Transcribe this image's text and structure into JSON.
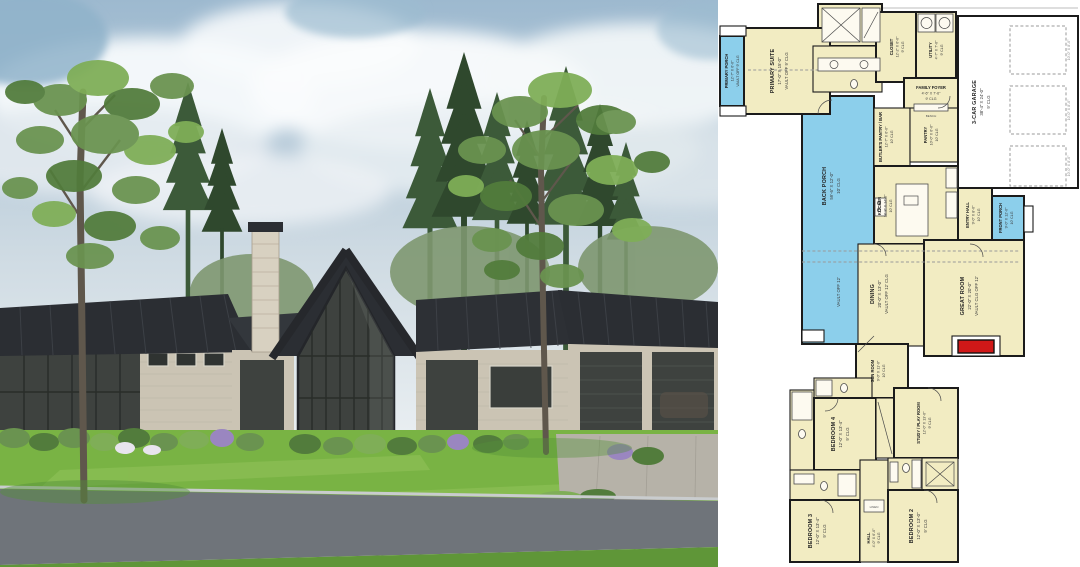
{
  "page": {
    "description": "Split image: modern ranch house exterior render (left) and floor plan (right)"
  },
  "palette": {
    "sky_top": "#9db9cf",
    "sky_bottom": "#e9eef1",
    "cloud": "#f7fafc",
    "grass": "#79b344",
    "grass_dark": "#5f9638",
    "road": "#6f747a",
    "curb": "#c9ccce",
    "roof": "#2b2e33",
    "stone": "#cbc4b4",
    "stone_light": "#d8d1c1",
    "glass": "#3e423f",
    "pine": "#3c5a39",
    "pine_dark": "#2f482d",
    "leaf": "#6a9350",
    "trunk": "#645a4e",
    "driveway": "#b6b2a8",
    "plan_room": "#f2ecc2",
    "plan_porch": "#8ccfeb",
    "plan_wall": "#1b1b1b",
    "fireplace": "#d01818"
  },
  "floor_plan": {
    "garage_door_label": "10'-0\" X 8'-0\"",
    "notes": {
      "vault_note": "VAULT OFF 12'",
      "bench": "BENCH",
      "linen": "LINEN"
    },
    "rooms": [
      {
        "name": "PRIMARY PORCH",
        "dims": "12'-7\" X 6'-0\"",
        "ceiling": "VAULT OFF 9' CLG"
      },
      {
        "name": "PRIMARY SUITE",
        "dims": "17'-0\" X 15'-0\"",
        "ceiling": "VAULT OFF 9' CLG"
      },
      {
        "name": "CLOSET",
        "dims": "12'-2\" X 6'-0\"",
        "ceiling": "9' CLG"
      },
      {
        "name": "UTILITY",
        "dims": "4'-7\" X 7'-0\"",
        "ceiling": "9' CLG"
      },
      {
        "name": "FAMILY FOYER",
        "dims": "4'-6\" X 7'-6\"",
        "ceiling": "9' CLG"
      },
      {
        "name": "3-CAR GARAGE",
        "dims": "38'-4\" X 24'-0\"",
        "ceiling": "9' CLG"
      },
      {
        "name": "BUTLER'S PANTRY / BAR",
        "dims": "12'-7\" X 6'-0\"",
        "ceiling": "10' CLG"
      },
      {
        "name": "PANTRY",
        "dims": "10'-0\" X 6'-0\"",
        "ceiling": "10' CLG"
      },
      {
        "name": "KITCHEN",
        "dims": "18'-8\" X 14'-6\"",
        "ceiling": "10' CLG"
      },
      {
        "name": "ENTRY HALL",
        "dims": "9'-0\" X 8'-0\"",
        "ceiling": "10' CLG"
      },
      {
        "name": "FRONT PORCH",
        "dims": "9'-0\" X 12'-0\"",
        "ceiling": "10' CLG"
      },
      {
        "name": "BACK PORCH",
        "dims": "59'-6\" X 12'-0\"",
        "ceiling": "10' CLG"
      },
      {
        "name": "DINING",
        "dims": "20'-0\" X 13'-0\"",
        "ceiling": "VAULT OFF 12' CLG"
      },
      {
        "name": "GREAT ROOM",
        "dims": "22'-0\" X 20'-0\"",
        "ceiling": "VAULT CLG OFF 12'"
      },
      {
        "name": "SUN ROOM",
        "dims": "9'-0\" X 11'-0\"",
        "ceiling": "10' CLG"
      },
      {
        "name": "BEDROOM 4",
        "dims": "12'-0\" X 13'-4\"",
        "ceiling": "9' CLG"
      },
      {
        "name": "STUDY / PLAY ROOM",
        "dims": "12'-0\" X 13'-0\"",
        "ceiling": "9' CLG"
      },
      {
        "name": "BEDROOM 3",
        "dims": "12'-0\" X 13'-4\"",
        "ceiling": "9' CLG"
      },
      {
        "name": "BEDROOM 2",
        "dims": "12'-0\" X 13'-0\"",
        "ceiling": "9' CLG"
      },
      {
        "name": "HALL",
        "dims": "4'-0\" X 6'-0\"",
        "ceiling": "9' CLG"
      }
    ]
  }
}
